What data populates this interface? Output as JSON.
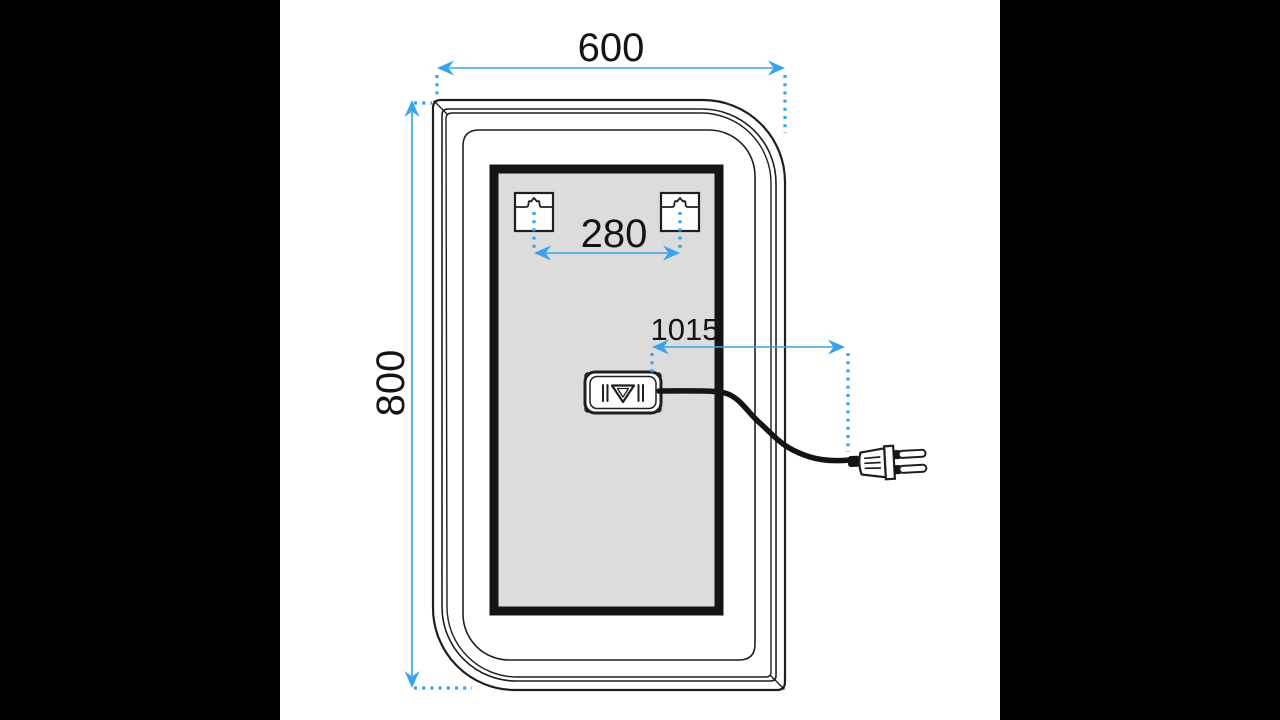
{
  "colors": {
    "accent": "#38a3e8",
    "ink": "#1f1f1f",
    "panel_fill": "#dcdcdc",
    "panel_border": "#151515",
    "background": "#ffffff",
    "letterbox": "#000000"
  },
  "diagram": {
    "dimensions": {
      "width_mm": "600",
      "height_mm": "800",
      "hook_spacing_mm": "280",
      "cable_length_mm": "1015"
    },
    "components": [
      "mirror-rear-view",
      "back-panel",
      "mounting-hook-left",
      "mounting-hook-right",
      "led-driver-box",
      "power-cable",
      "power-plug"
    ]
  }
}
